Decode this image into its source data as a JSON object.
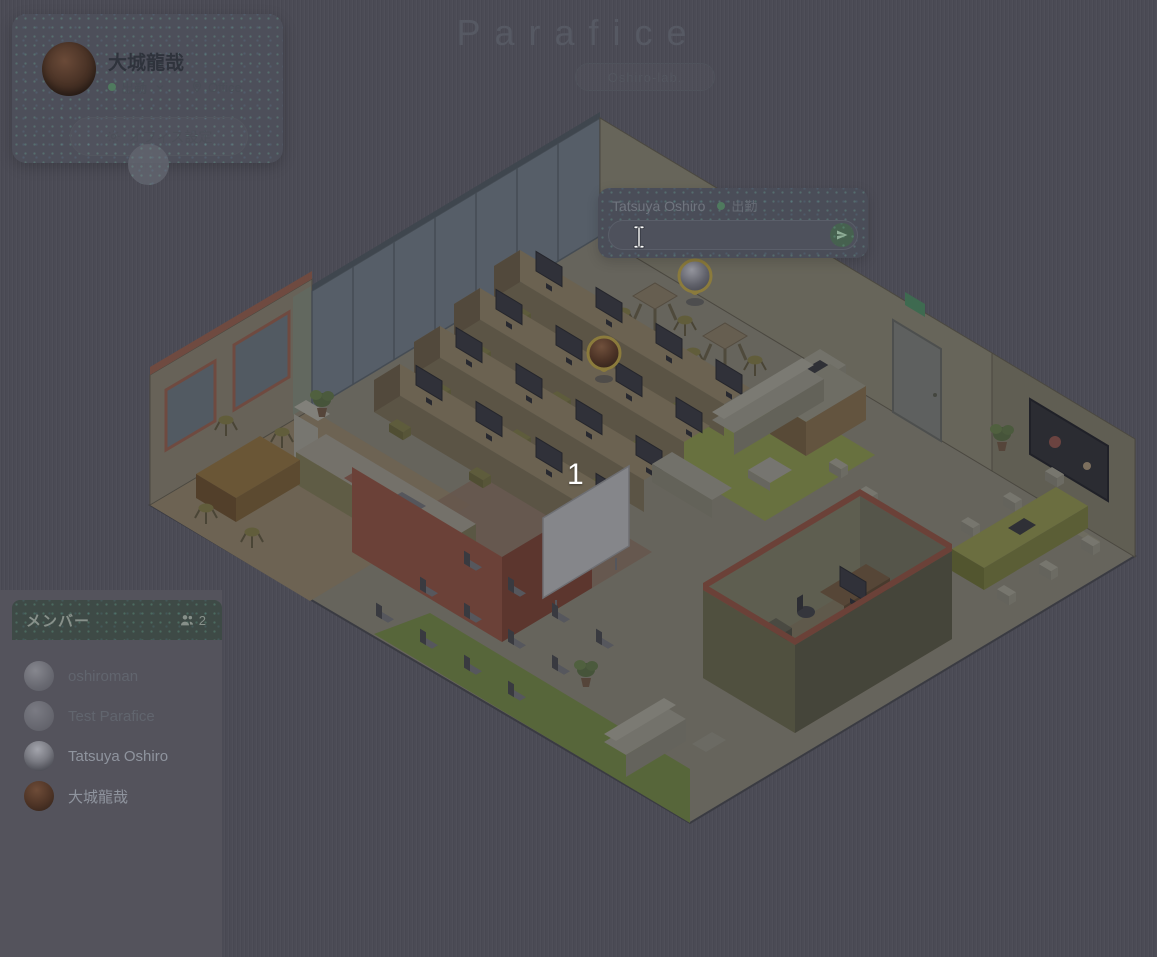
{
  "app": {
    "logo": "Parafice",
    "workspace_button": "Oshiro-lab."
  },
  "user_card": {
    "name": "大城龍哉",
    "status": "出勤",
    "location": "Office",
    "settings_button": "オフィス設定"
  },
  "status_dialog": {
    "user": "Tatsuya Oshiro",
    "status": "出勤",
    "input_value": ""
  },
  "member_panel": {
    "title": "メンバー",
    "online_count": "2",
    "members": [
      {
        "name": "oshiroman"
      },
      {
        "name": "Test Parafice"
      },
      {
        "name": "Tatsuya Oshiro"
      },
      {
        "name": "大城龍哉"
      }
    ]
  },
  "map": {
    "annotation": "1"
  },
  "colors": {
    "status_green": "#4f7a5e",
    "send_button_green": "#46614f",
    "member_header_green": "#3e4a46",
    "pin_ring_gold": "#8b7b3c",
    "background": "#4b4b55",
    "annotation": "#ffffff"
  }
}
